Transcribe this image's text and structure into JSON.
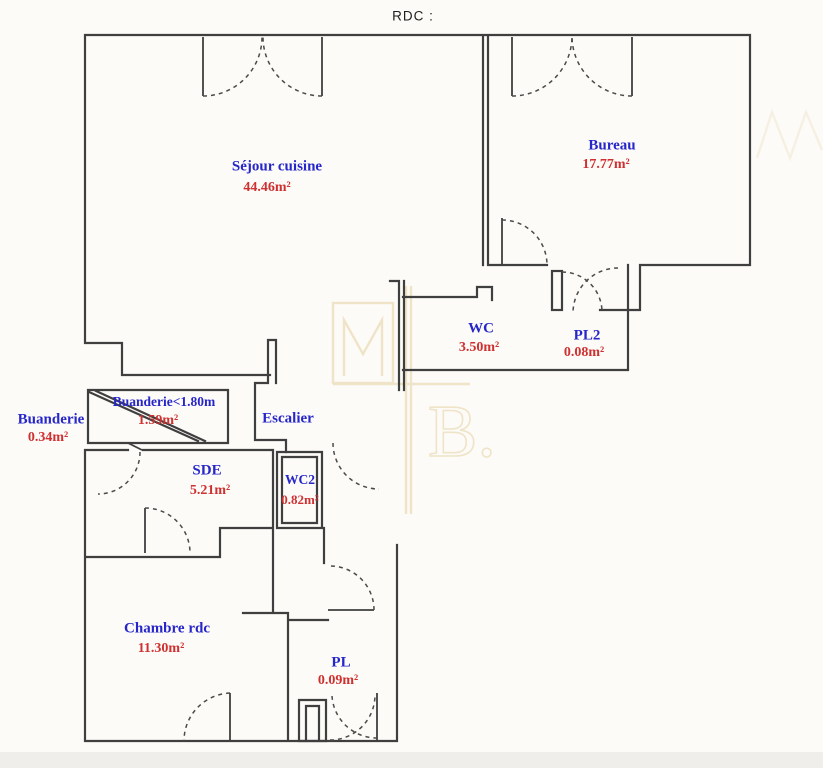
{
  "title": "RDC :",
  "colors": {
    "blue": "#2626c9",
    "red": "#cf3030",
    "wall": "#3f3f3f",
    "beige": "#efe3c5",
    "bg": "#fcfbf8"
  },
  "watermark": {
    "letter_m": "M",
    "letter_b": "B."
  },
  "rooms": [
    {
      "name": "Séjour cuisine",
      "area": "44.46m²"
    },
    {
      "name": "Bureau",
      "area": "17.77m²"
    },
    {
      "name": "WC",
      "area": "3.50m²"
    },
    {
      "name": "PL2",
      "area": "0.08m²"
    },
    {
      "name": "Buanderie",
      "area": "0.34m²"
    },
    {
      "name": "Buanderie<1.80m",
      "area": "1.59m²"
    },
    {
      "name": "Escalier",
      "area": ""
    },
    {
      "name": "SDE",
      "area": "5.21m²"
    },
    {
      "name": "WC2",
      "area": "0.82m²"
    },
    {
      "name": "Chambre rdc",
      "area": "11.30m²"
    },
    {
      "name": "PL",
      "area": "0.09m²"
    }
  ]
}
